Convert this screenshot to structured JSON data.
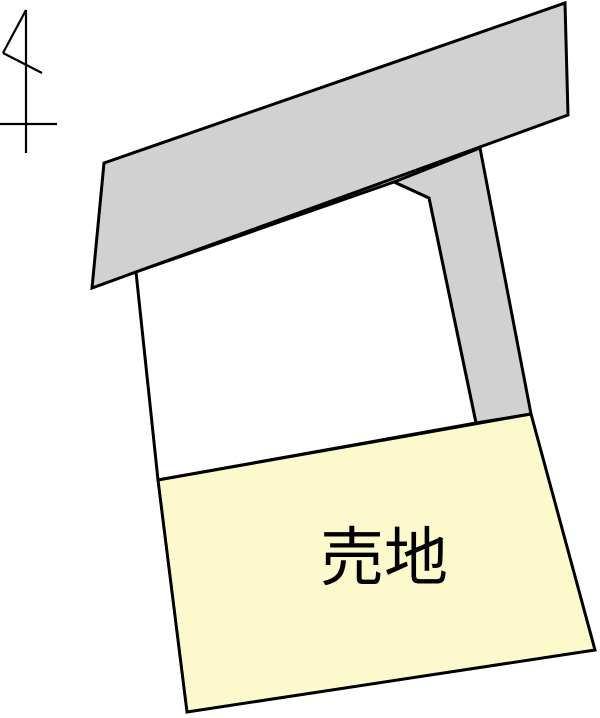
{
  "canvas": {
    "width": 600,
    "height": 718,
    "background": "#ffffff"
  },
  "colors": {
    "road_fill": "#d1d1d1",
    "sale_plot_fill": "#fcfacc",
    "neighbor_plot_fill": "#ffffff",
    "outline": "#000000"
  },
  "parcels": [
    {
      "name": "road-upper-band",
      "fill": "road_fill",
      "stroke_width": 3,
      "points": [
        [
          104,
          163
        ],
        [
          565,
          3
        ],
        [
          568,
          115
        ],
        [
          92,
          288
        ]
      ]
    },
    {
      "name": "road-side-branch",
      "fill": "road_fill",
      "stroke_width": 3,
      "points": [
        [
          394,
          182
        ],
        [
          480,
          148
        ],
        [
          531,
          414
        ],
        [
          476,
          423
        ],
        [
          429,
          198
        ]
      ]
    },
    {
      "name": "neighbor-plot",
      "fill": "neighbor_plot_fill",
      "stroke_width": 3,
      "points": [
        [
          136,
          272
        ],
        [
          394,
          182
        ],
        [
          429,
          198
        ],
        [
          476,
          423
        ],
        [
          158,
          480
        ]
      ]
    },
    {
      "name": "sale-plot",
      "fill": "sale_plot_fill",
      "stroke_width": 3,
      "points": [
        [
          158,
          480
        ],
        [
          531,
          414
        ],
        [
          595,
          650
        ],
        [
          187,
          712
        ]
      ]
    }
  ],
  "north_arrow": {
    "stroke_width": 2.2,
    "segments": [
      [
        [
          26,
          10
        ],
        [
          26,
          153
        ]
      ],
      [
        [
          0,
          124
        ],
        [
          57,
          124
        ]
      ],
      [
        [
          26,
          10
        ],
        [
          3,
          53
        ]
      ],
      [
        [
          3,
          53
        ],
        [
          42,
          73
        ]
      ]
    ]
  },
  "label": {
    "text": "売地",
    "x": 384,
    "y": 580,
    "font_size": 64,
    "color": "#000000"
  }
}
